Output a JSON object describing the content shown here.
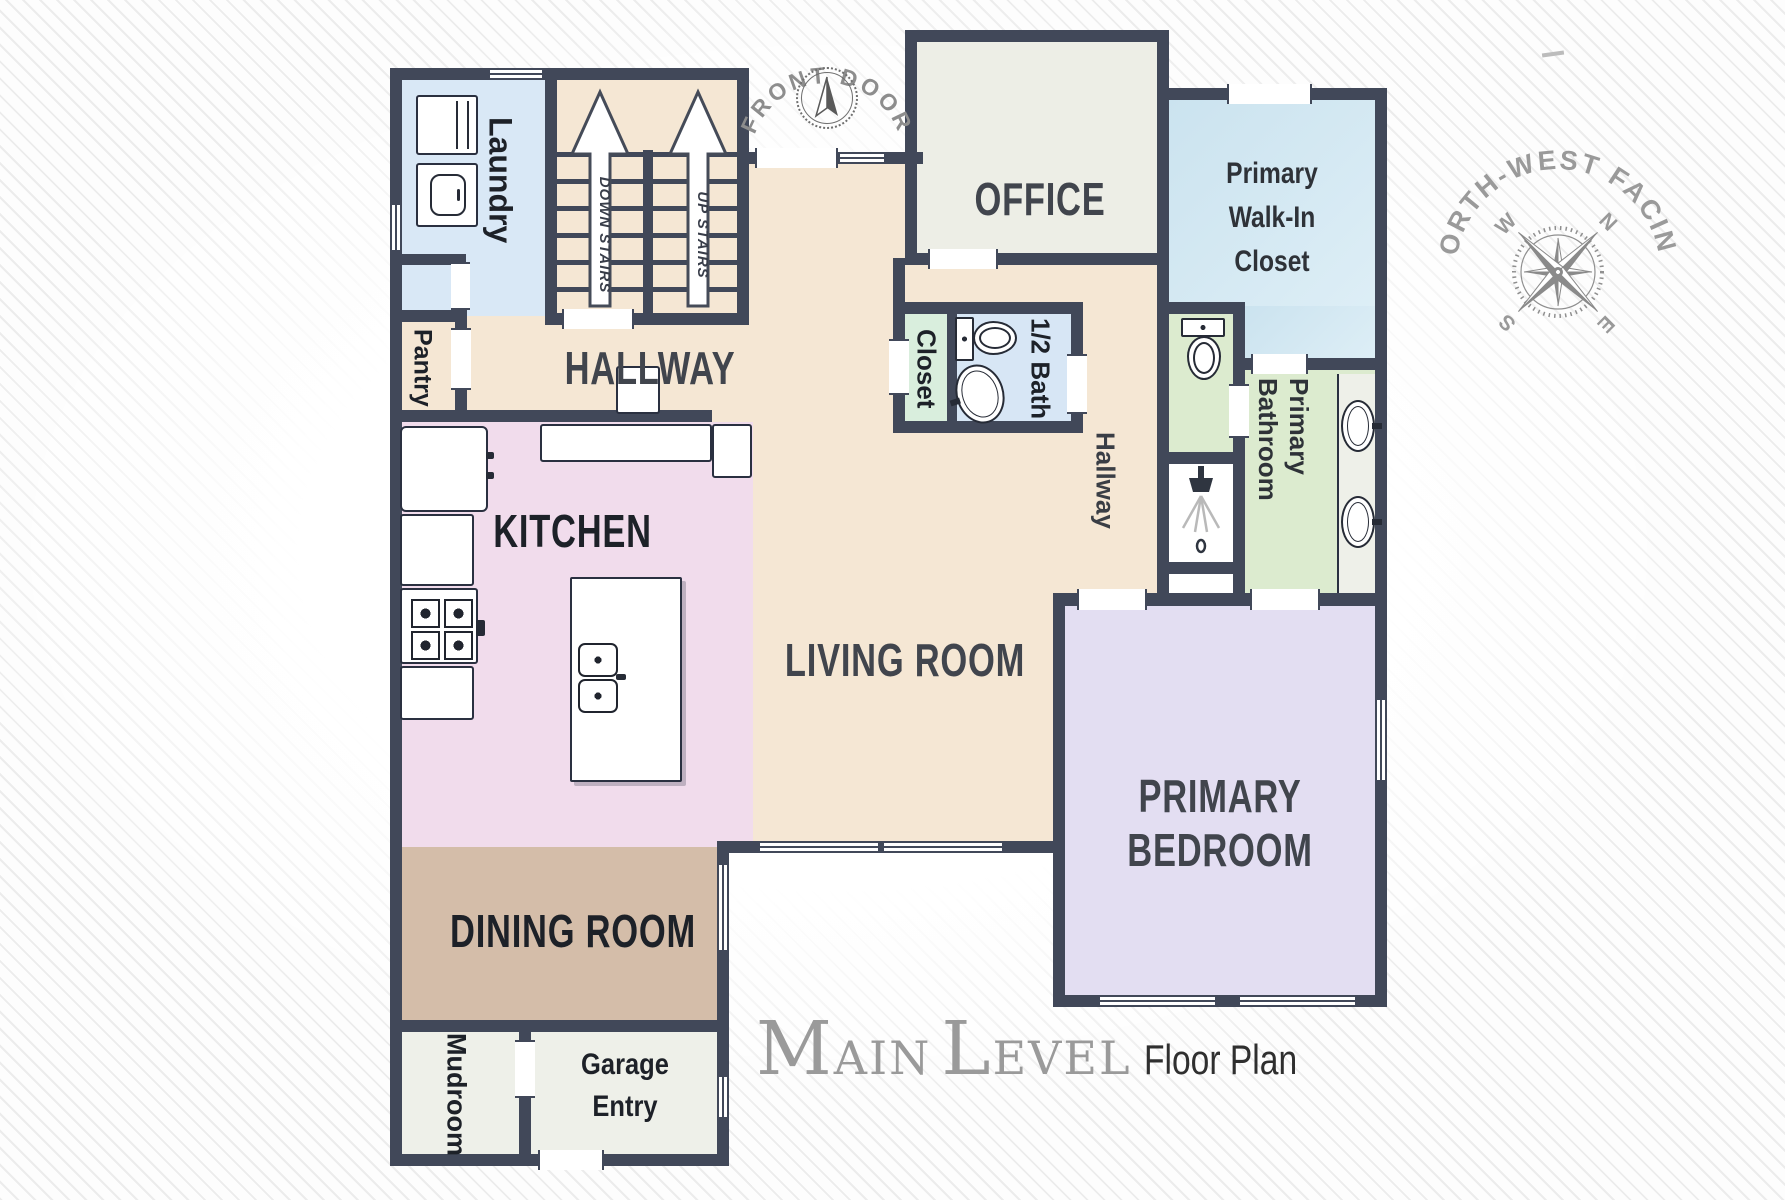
{
  "title": {
    "word1": "Main",
    "word2": "Level",
    "suffix": "Floor Plan"
  },
  "front_door": {
    "label": "FRONT DOOR"
  },
  "orientation": {
    "label": "NORTH-WEST FACING",
    "n": "N",
    "e": "E",
    "s": "S",
    "w": "W"
  },
  "rooms": {
    "laundry": {
      "label": "Laundry"
    },
    "pantry": {
      "label": "Pantry"
    },
    "stairs": {
      "down": "DOWN STAIRS",
      "up": "UP STAIRS"
    },
    "hallway": {
      "label": "HALLWAY"
    },
    "office": {
      "label": "OFFICE"
    },
    "walk_in_closet": {
      "label": "Primary Walk-In Closet"
    },
    "closet": {
      "label": "Closet"
    },
    "half_bath": {
      "label": "1/2 Bath"
    },
    "hall_small": {
      "label": "Hallway"
    },
    "primary_bathroom": {
      "label": "Primary Bathroom"
    },
    "kitchen": {
      "label": "KITCHEN"
    },
    "living_room": {
      "label": "LIVING ROOM"
    },
    "dining_room": {
      "label": "DINING ROOM"
    },
    "primary_bedroom": {
      "label": "PRIMARY BEDROOM"
    },
    "mudroom": {
      "label": "Mudroom"
    },
    "garage_entry": {
      "label": "Garage Entry"
    }
  },
  "colors": {
    "wall": "#414859",
    "hall_beige": "#f5e7d4",
    "kitchen_pink": "#f1dcec",
    "dining_tan": "#d4bda9",
    "laundry_blue": "#d9e8f6",
    "walkin_closet_blue": "#d3e8f2",
    "office_gray": "#edeee6",
    "closet_mint": "#d9eedd",
    "half_bath_blue": "#d7e6f5",
    "bathroom_green": "#dcebcf",
    "bedroom_lavender": "#e3def2",
    "utility_offwhite": "#eef0e9",
    "label_dark": "#1d2128",
    "label_gray": "#41454d",
    "decor_gray": "#9a9a9a"
  }
}
